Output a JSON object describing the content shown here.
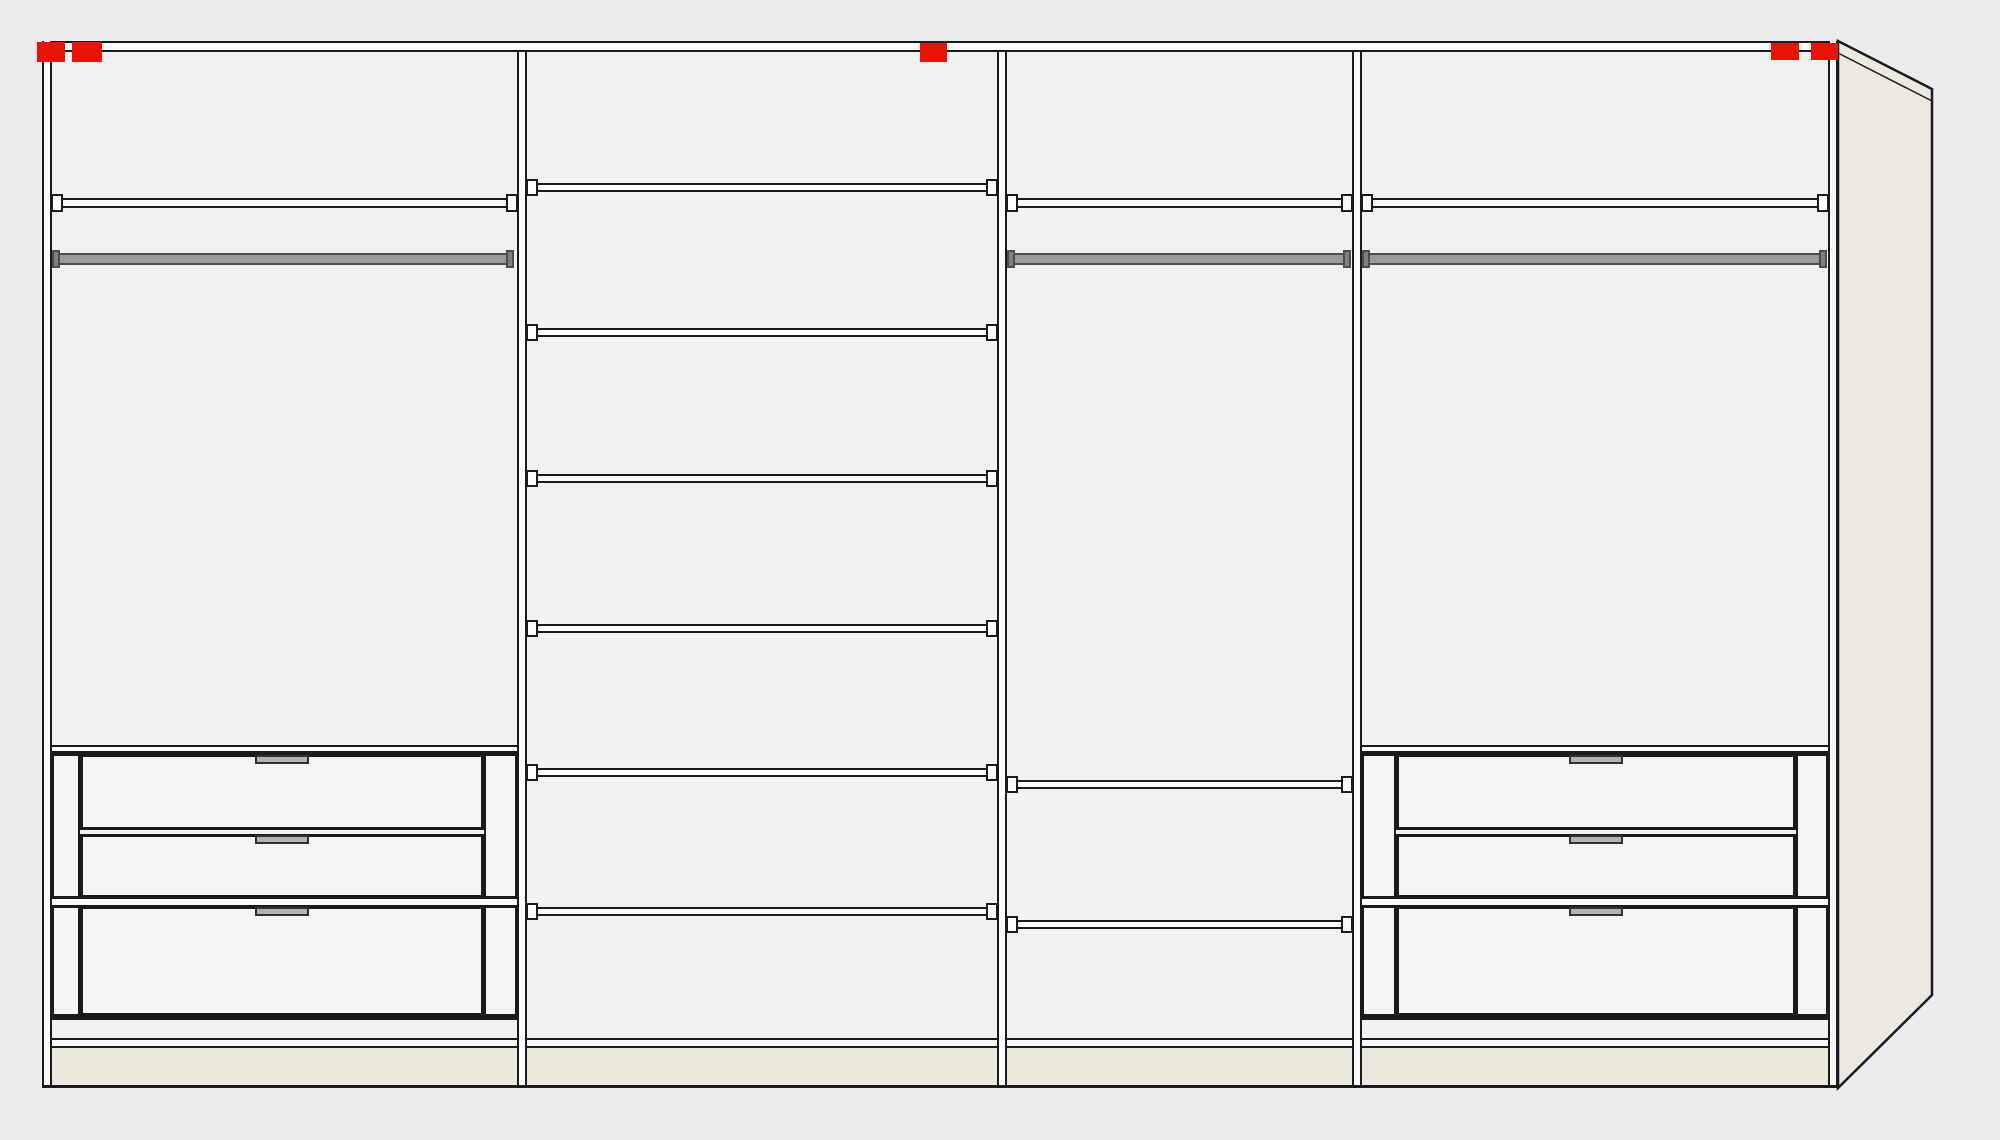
{
  "canvas": {
    "width": 2000,
    "height": 1140,
    "background": "#ececec"
  },
  "palette": {
    "line": "#1b1b1b",
    "interior": "#f1f1ef",
    "gap_white": "#fcfcfb",
    "drawer_front": "#f6f6f5",
    "marker_red": "#e91405",
    "rail_gray": "#9a9a9a",
    "rail_border": "#4d4d4d",
    "rail_cap": "#7f7f7f",
    "handle_gray": "#b3b3b3",
    "handle_border": "#303030",
    "plinth_cream": "#ebe7da",
    "side_panel_cream": "#ece9e0"
  },
  "wardrobe": {
    "frame": {
      "left": 42,
      "top": 41,
      "right": 1838,
      "bottom": 1088,
      "edge_width": 10,
      "top_band_h": 11,
      "bottom_line_h": 3
    },
    "bottom_shelf_band": {
      "y": 1038,
      "h": 10
    },
    "plinth": {
      "y": 1048,
      "h": 37
    },
    "divider_width": 10,
    "dividers": [
      517,
      997,
      1352
    ],
    "sections": [
      {
        "id": "section-1",
        "x": 52,
        "width": 465,
        "top_shelf": 198,
        "rail": {
          "bar_x": 58,
          "bar_w": 450,
          "y": 253
        },
        "shelves": [],
        "drawer_unit": {
          "x": 52,
          "w": 465,
          "stile_left": 28,
          "stile_right": 33,
          "top_band_y": 745,
          "separator_y": 897,
          "bottom_line_y": 1016,
          "drawers": [
            {
              "y": 754,
              "h": 76
            },
            {
              "y": 834,
              "h": 64
            },
            {
              "y": 906,
              "h": 110
            }
          ]
        }
      },
      {
        "id": "section-2",
        "x": 527,
        "width": 470,
        "shelves": [
          183,
          328,
          474,
          624,
          768,
          907
        ]
      },
      {
        "id": "section-3",
        "x": 1007,
        "width": 345,
        "top_shelf": 198,
        "rail": {
          "bar_x": 1013,
          "bar_w": 332,
          "y": 253
        },
        "shelves": [
          780,
          920
        ]
      },
      {
        "id": "section-4",
        "x": 1362,
        "width": 466,
        "top_shelf": 198,
        "rail": {
          "bar_x": 1368,
          "bar_w": 453,
          "y": 253
        },
        "shelves": [],
        "drawer_unit": {
          "x": 1362,
          "w": 466,
          "stile_left": 34,
          "stile_right": 32,
          "top_band_y": 745,
          "separator_y": 897,
          "bottom_line_y": 1016,
          "drawers": [
            {
              "y": 754,
              "h": 76
            },
            {
              "y": 834,
              "h": 64
            },
            {
              "y": 906,
              "h": 110
            }
          ]
        }
      }
    ],
    "markers": [
      {
        "id": "marker-1",
        "x": 37,
        "y": 42,
        "w": 28,
        "h": 20
      },
      {
        "id": "marker-2",
        "x": 72,
        "y": 42,
        "w": 30,
        "h": 20
      },
      {
        "id": "marker-3",
        "x": 920,
        "y": 43,
        "w": 27,
        "h": 19
      },
      {
        "id": "marker-4",
        "x": 1771,
        "y": 43,
        "w": 28,
        "h": 17
      },
      {
        "id": "marker-5",
        "x": 1811,
        "y": 43,
        "w": 27,
        "h": 17
      }
    ],
    "side_panel": {
      "points": [
        [
          1838,
          41
        ],
        [
          1932,
          89
        ],
        [
          1932,
          995
        ],
        [
          1838,
          1088
        ]
      ],
      "inner_line": [
        [
          1838,
          53
        ],
        [
          1932,
          101
        ]
      ]
    }
  }
}
